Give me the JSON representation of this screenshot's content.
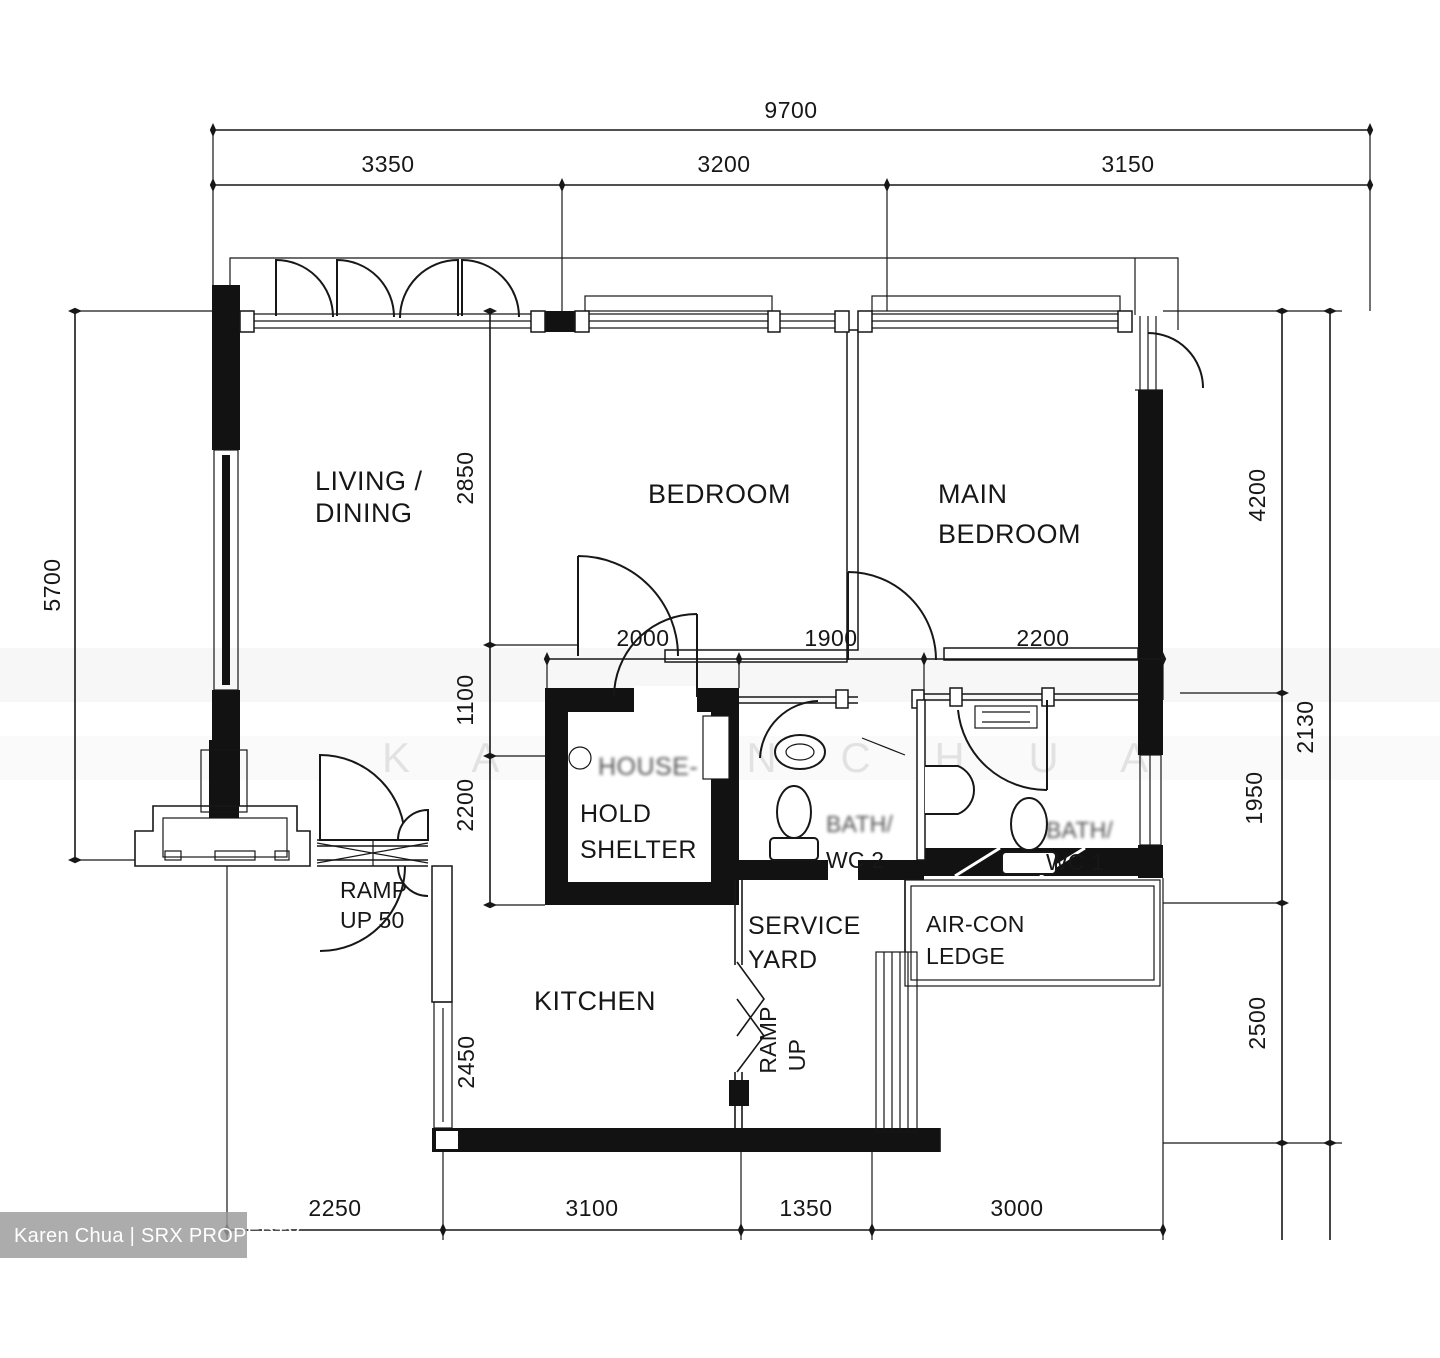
{
  "watermark": {
    "credit": "Karen Chua | SRX PROPERTY",
    "faint": "K A R E N   C H U A"
  },
  "rooms": {
    "living_dining": {
      "line1": "LIVING /",
      "line2": "DINING"
    },
    "bedroom": {
      "label": "BEDROOM"
    },
    "main_bedroom": {
      "line1": "MAIN",
      "line2": "BEDROOM"
    },
    "household_shelter": {
      "line1": "HOUSE-",
      "line2": "HOLD",
      "line3": "SHELTER"
    },
    "bath_wc_2": {
      "line1": "BATH/",
      "line2": "WC 2"
    },
    "bath_wc_1": {
      "line1": "BATH/",
      "line2": "WC 1"
    },
    "service_yard": {
      "line1": "SERVICE",
      "line2": "YARD"
    },
    "air_con_ledge": {
      "line1": "AIR-CON",
      "line2": "LEDGE"
    },
    "kitchen": {
      "label": "KITCHEN"
    },
    "ramp_up_50": {
      "line1": "RAMP",
      "line2": "UP 50"
    },
    "ramp_up": {
      "line1": "RAMP",
      "line2": "UP"
    }
  },
  "dimensions": {
    "top_total": "9700",
    "top_seg1": "3350",
    "top_seg2": "3200",
    "top_seg3": "3150",
    "left_total": "5700",
    "left_seg1": "2850",
    "left_seg2": "1100",
    "left_seg3": "2200",
    "mid_seg1": "2000",
    "mid_seg2": "1900",
    "mid_seg3": "2200",
    "right_seg1": "4200",
    "right_seg2": "1950",
    "right_seg3": "2500",
    "right_outer": "2130",
    "bottom_seg1": "2250",
    "bottom_seg2": "3100",
    "bottom_seg3": "1350",
    "bottom_seg4": "3000",
    "kitchen_window": "2450"
  }
}
